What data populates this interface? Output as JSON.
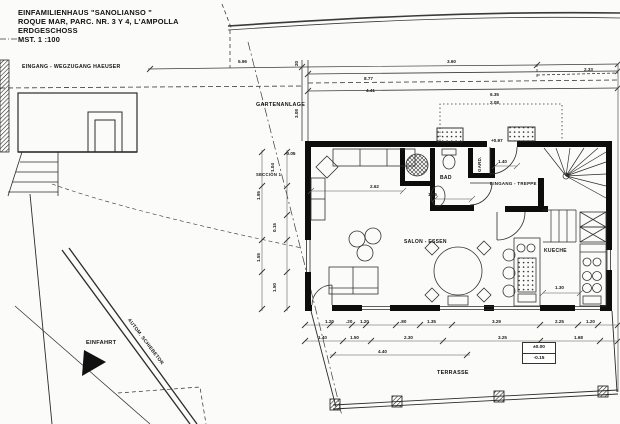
{
  "title_block": {
    "line1": "EINFAMILIENHAUS  \"SANOLIANSO \"",
    "line2": "ROQUE MAR, PARC. NR. 3 Y 4, L'AMPOLLA",
    "line3": "ERDGESCHOSS",
    "line4": "MST.   1 :100"
  },
  "site_labels": {
    "entrance_path": "EINGANG - WEGZUGANG HAEUSER",
    "garden": "GARTENANLAGE",
    "driveway": "EINFAHRT",
    "sliding_gate": "AUTOM. SCHIEBETOR",
    "section": "SECCIÓN 1",
    "terrace": "TERRASSE"
  },
  "room_labels": {
    "living_dining": "SALON - ESSEN",
    "bath": "BAD",
    "wardrobe": "GARD.",
    "entrance_stairs": "EINGANG - TREPPE",
    "kitchen": "KUECHE"
  },
  "levels": {
    "terrace_upper": "±0.00",
    "terrace_lower": "-0.15",
    "entrance": "+0.97",
    "corner": "-0.05"
  },
  "dimensions": {
    "items": [
      {
        "t": "5.96",
        "x": 238,
        "y": 59,
        "r": 0
      },
      {
        "t": "3.60",
        "x": 447,
        "y": 59,
        "r": 0
      },
      {
        "t": "2.33",
        "x": 584,
        "y": 67,
        "r": 0
      },
      {
        "t": "8.77",
        "x": 364,
        "y": 76,
        "r": 0
      },
      {
        "t": "4.41",
        "x": 366,
        "y": 88,
        "r": 0
      },
      {
        "t": "20",
        "x": 294,
        "y": 66,
        "r": -90
      },
      {
        "t": "3.08",
        "x": 294,
        "y": 118,
        "r": -90
      },
      {
        "t": "6.35",
        "x": 490,
        "y": 92,
        "r": 0
      },
      {
        "t": "2.08",
        "x": 490,
        "y": 100,
        "r": 0
      },
      {
        "t": "2.62",
        "x": 370,
        "y": 184,
        "r": 0
      },
      {
        "t": "1.65",
        "x": 428,
        "y": 192,
        "r": 0
      },
      {
        "t": "1.40",
        "x": 498,
        "y": 159,
        "r": 0
      },
      {
        "t": "1.30",
        "x": 555,
        "y": 285,
        "r": 0
      },
      {
        "t": "1.04",
        "x": 270,
        "y": 172,
        "r": -90
      },
      {
        "t": "1.95",
        "x": 256,
        "y": 200,
        "r": -90
      },
      {
        "t": "0.15",
        "x": 272,
        "y": 232,
        "r": -90
      },
      {
        "t": "1.55",
        "x": 256,
        "y": 262,
        "r": -90
      },
      {
        "t": "1.50",
        "x": 272,
        "y": 292,
        "r": -90
      },
      {
        "t": "1.20",
        "x": 325,
        "y": 319,
        "r": 0
      },
      {
        "t": ".20",
        "x": 346,
        "y": 319,
        "r": 0
      },
      {
        "t": "1.20",
        "x": 360,
        "y": 319,
        "r": 0
      },
      {
        "t": ".80",
        "x": 400,
        "y": 319,
        "r": 0
      },
      {
        "t": "1.35",
        "x": 427,
        "y": 319,
        "r": 0
      },
      {
        "t": "3.29",
        "x": 492,
        "y": 319,
        "r": 0
      },
      {
        "t": "2.25",
        "x": 555,
        "y": 319,
        "r": 0
      },
      {
        "t": "1.20",
        "x": 586,
        "y": 319,
        "r": 0
      },
      {
        "t": "1.40",
        "x": 318,
        "y": 335,
        "r": 0
      },
      {
        "t": "1.50",
        "x": 350,
        "y": 335,
        "r": 0
      },
      {
        "t": "2.30",
        "x": 404,
        "y": 335,
        "r": 0
      },
      {
        "t": "3.25",
        "x": 498,
        "y": 335,
        "r": 0
      },
      {
        "t": "1.68",
        "x": 574,
        "y": 335,
        "r": 0
      },
      {
        "t": "4.40",
        "x": 378,
        "y": 349,
        "r": 0
      }
    ]
  },
  "drawing_colors": {
    "paper": "#fbfbf9",
    "line": "#2b2b2b",
    "wall": "#0d0d0d"
  }
}
